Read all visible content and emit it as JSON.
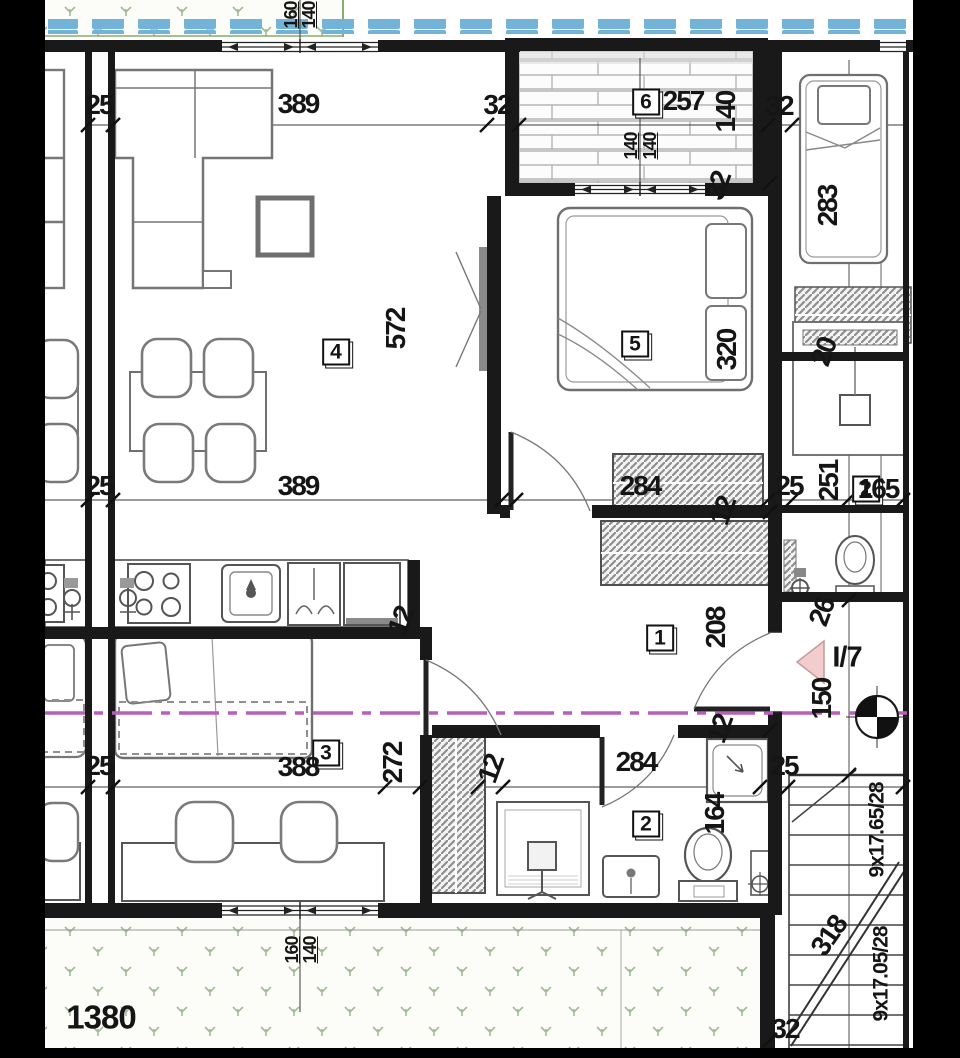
{
  "document": {
    "type": "architectural floor plan (apartment)",
    "section_label": "I/7",
    "room_numbers": [
      "1",
      "2",
      "3",
      "4",
      "5",
      "6"
    ],
    "stair_specs": [
      "9x17.65/28",
      "9x17.05/28"
    ],
    "site_width": "1380"
  },
  "colors": {
    "wall_black": "#191919",
    "furniture_gray": "#6f6f6f",
    "tile_blue": "#74b3d8",
    "grass_green": "#a3bb97",
    "grass_border_green": "#86ad6f",
    "section_magenta": "#b95fb9",
    "triangle_pink_fill": "#f3cdcd",
    "triangle_pink_stroke": "#c59a9a",
    "hatch_gray": "#8f8f8f",
    "crop_bar_black": "#000000"
  },
  "labels": [
    {
      "t": "6",
      "x": 646,
      "y": 102,
      "r": 0,
      "k": "room",
      "n": "room-number-terrace"
    },
    {
      "t": "4",
      "x": 336,
      "y": 352,
      "r": 0,
      "k": "room",
      "n": "room-number-living"
    },
    {
      "t": "5",
      "x": 635,
      "y": 344,
      "r": 0,
      "k": "room",
      "n": "room-number-bedroom"
    },
    {
      "t": "3",
      "x": 326,
      "y": 753,
      "r": 0,
      "k": "room",
      "n": "room-number-room3"
    },
    {
      "t": "1",
      "x": 660,
      "y": 638,
      "r": 0,
      "k": "room",
      "n": "room-number-hall"
    },
    {
      "t": "2",
      "x": 646,
      "y": 824,
      "r": 0,
      "k": "room",
      "n": "room-number-bath"
    },
    {
      "t": "2",
      "x": 866,
      "y": 489,
      "r": 0,
      "k": "room",
      "n": "room-number-neighbor"
    },
    {
      "t": "160",
      "x": 291,
      "y": 15,
      "r": -90,
      "k": "small"
    },
    {
      "t": "140",
      "x": 309,
      "y": 15,
      "r": -90,
      "k": "small"
    },
    {
      "t": "25",
      "x": 99,
      "y": 105,
      "r": 0,
      "k": "dim"
    },
    {
      "t": "389",
      "x": 298,
      "y": 104,
      "r": 0,
      "k": "dim"
    },
    {
      "t": "32",
      "x": 497,
      "y": 105,
      "r": 0,
      "k": "dim"
    },
    {
      "t": "257",
      "x": 683,
      "y": 101,
      "r": 0,
      "k": "dim"
    },
    {
      "t": "140",
      "x": 726,
      "y": 112,
      "r": -90,
      "k": "dim"
    },
    {
      "t": "32",
      "x": 779,
      "y": 106,
      "r": 0,
      "k": "dim"
    },
    {
      "t": "140",
      "x": 631,
      "y": 146,
      "r": -90,
      "k": "small"
    },
    {
      "t": "140",
      "x": 650,
      "y": 146,
      "r": -90,
      "k": "small"
    },
    {
      "t": "32",
      "x": 718,
      "y": 186,
      "r": -70,
      "k": "dim"
    },
    {
      "t": "283",
      "x": 828,
      "y": 206,
      "r": -90,
      "k": "dim"
    },
    {
      "t": "572",
      "x": 396,
      "y": 329,
      "r": -90,
      "k": "dim"
    },
    {
      "t": "320",
      "x": 727,
      "y": 350,
      "r": -90,
      "k": "dim"
    },
    {
      "t": "20",
      "x": 824,
      "y": 352,
      "r": -70,
      "k": "dim"
    },
    {
      "t": "25",
      "x": 99,
      "y": 486,
      "r": 0,
      "k": "dim"
    },
    {
      "t": "389",
      "x": 298,
      "y": 486,
      "r": 0,
      "k": "dim"
    },
    {
      "t": "284",
      "x": 640,
      "y": 486,
      "r": 0,
      "k": "dim"
    },
    {
      "t": "12",
      "x": 723,
      "y": 511,
      "r": -70,
      "k": "dim"
    },
    {
      "t": "25",
      "x": 789,
      "y": 486,
      "r": 0,
      "k": "dim"
    },
    {
      "t": "251",
      "x": 829,
      "y": 481,
      "r": -90,
      "k": "dim"
    },
    {
      "t": "165",
      "x": 878,
      "y": 489,
      "r": 0,
      "k": "dim"
    },
    {
      "t": "208",
      "x": 716,
      "y": 628,
      "r": -90,
      "k": "dim"
    },
    {
      "t": "12",
      "x": 401,
      "y": 621,
      "r": -70,
      "k": "dim"
    },
    {
      "t": "26",
      "x": 822,
      "y": 612,
      "r": -70,
      "k": "dim"
    },
    {
      "t": "I/7",
      "x": 847,
      "y": 658,
      "r": 0,
      "k": "unit",
      "n": "unit-label"
    },
    {
      "t": "150",
      "x": 822,
      "y": 699,
      "r": -90,
      "k": "dim"
    },
    {
      "t": "25",
      "x": 99,
      "y": 766,
      "r": 0,
      "k": "dim"
    },
    {
      "t": "388",
      "x": 298,
      "y": 767,
      "r": 0,
      "k": "dim"
    },
    {
      "t": "272",
      "x": 393,
      "y": 763,
      "r": -90,
      "k": "dim"
    },
    {
      "t": "12",
      "x": 491,
      "y": 769,
      "r": -70,
      "k": "dim"
    },
    {
      "t": "284",
      "x": 636,
      "y": 762,
      "r": 0,
      "k": "dim"
    },
    {
      "t": "12",
      "x": 720,
      "y": 729,
      "r": -70,
      "k": "dim"
    },
    {
      "t": "25",
      "x": 784,
      "y": 766,
      "r": 0,
      "k": "dim"
    },
    {
      "t": "164",
      "x": 715,
      "y": 814,
      "r": -90,
      "k": "dim"
    },
    {
      "t": "318",
      "x": 829,
      "y": 936,
      "r": -55,
      "k": "dim"
    },
    {
      "t": "9x17.65/28",
      "x": 877,
      "y": 830,
      "r": -90,
      "k": "stair",
      "n": "stair-spec-upper"
    },
    {
      "t": "9x17.05/28",
      "x": 881,
      "y": 974,
      "r": -90,
      "k": "stair",
      "n": "stair-spec-lower"
    },
    {
      "t": "32",
      "x": 785,
      "y": 1029,
      "r": 0,
      "k": "dim"
    },
    {
      "t": "1380",
      "x": 101,
      "y": 1017,
      "r": 0,
      "k": "big",
      "n": "site-dimension"
    },
    {
      "t": "160",
      "x": 292,
      "y": 950,
      "r": -90,
      "k": "small"
    },
    {
      "t": "140",
      "x": 310,
      "y": 950,
      "r": -90,
      "k": "small"
    }
  ]
}
